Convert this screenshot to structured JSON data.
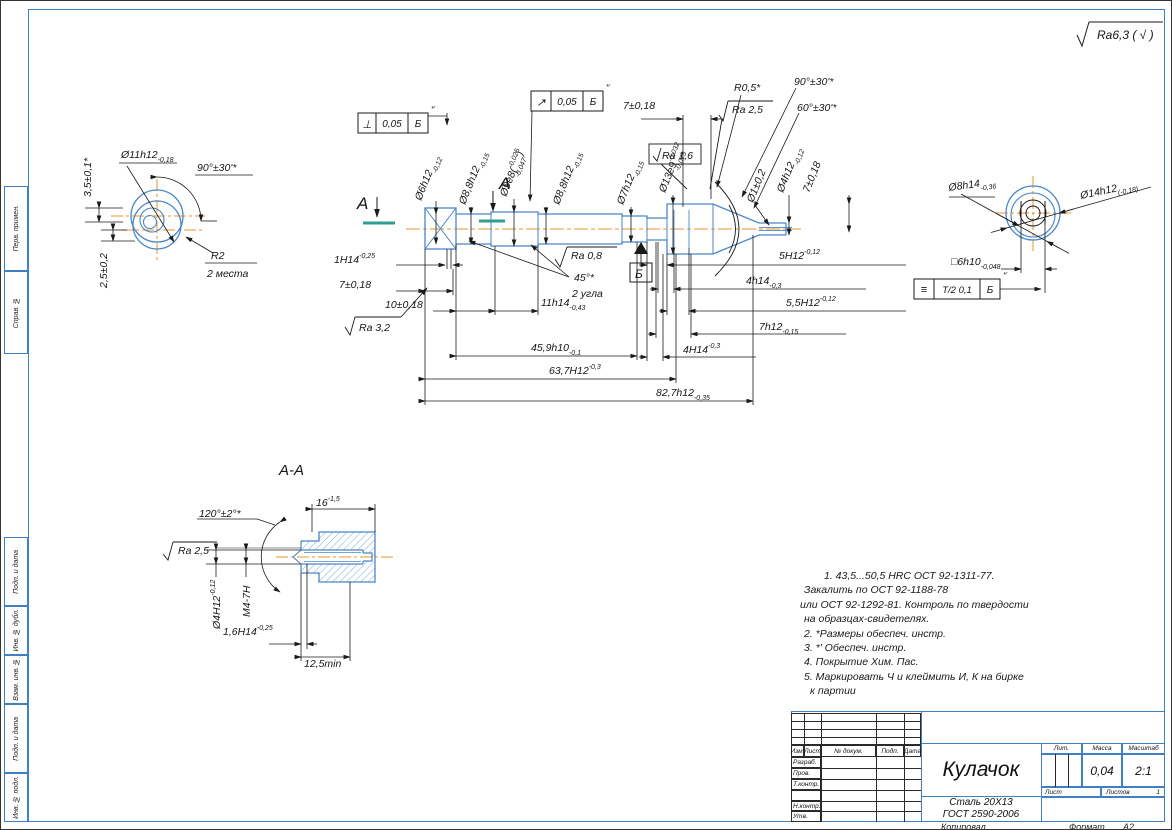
{
  "sheet": {
    "general_roughness": "Ra6,3 ( √ )",
    "copied": "Копировал",
    "format_label": "Формат",
    "format_value": "А2"
  },
  "colors": {
    "outline_blue": "#4a86c8",
    "centerline_orange": "#e8932c",
    "section_teal": "#2f9e8f",
    "line_black": "#1a1a1a"
  },
  "margin_stamps": [
    "Перв. примен.",
    "Справ. №",
    "Подп. и дата",
    "Инв. № дубл.",
    "Взам. инв. №",
    "Подп. и дата",
    "Инв. № подл."
  ],
  "gdt": [
    {
      "sym": "⊥",
      "val": "0,05",
      "datum": "Б",
      "note": "*'"
    },
    {
      "sym": "↗",
      "val": "0,05",
      "datum": "Б",
      "note": "*'"
    },
    {
      "sym": "≡",
      "val": "Т/2 0,1",
      "datum": "Б",
      "note": "*'"
    }
  ],
  "datum_label": "Б",
  "notes": {
    "lines": [
      {
        "t": "1. 43,5...50,5 HRC ОСТ 92-1311-77.",
        "ind": 28
      },
      {
        "t": "Закалить по ОСТ 92-1188-78",
        "ind": 8
      },
      {
        "t": "или ОСТ 92-1292-81. Контроль по твердости",
        "ind": 4
      },
      {
        "t": "на образцах-свидетелях.",
        "ind": 8
      },
      {
        "t": "2. *Размеры обеспеч. инстр.",
        "ind": 8
      },
      {
        "t": "3. *' Обеспеч. инстр.",
        "ind": 8
      },
      {
        "t": "4. Покрытие Хим. Пас.",
        "ind": 8
      },
      {
        "t": "5. Маркировать Ч и клеймить И, К на бирке",
        "ind": 8
      },
      {
        "t": "к партии",
        "ind": 14
      }
    ]
  },
  "title_block": {
    "header": {
      "izm": "Изм.",
      "list": "Лист",
      "doc": "№ докум.",
      "sign": "Подп.",
      "date": "Дата"
    },
    "rows": [
      "Разраб.",
      "Пров.",
      "Т.контр.",
      "",
      "Н.контр.",
      "Утв."
    ],
    "part_name": "Кулачок",
    "material_line1": "Сталь 20Х13",
    "material_line2": "ГОСТ 2590-2006",
    "lit_label": "Лит.",
    "mass_label": "Масса",
    "scale_label": "Масштаб",
    "mass_value": "0,04",
    "scale_value": "2:1",
    "sheet_label": "Лист",
    "sheets_label": "Листов",
    "sheets_value": "1"
  },
  "labels": [
    {
      "x": 420,
      "y": 200,
      "r": -68,
      "p": [
        {
          "t": "Ø6h12"
        },
        {
          "t": "-0,12",
          "dy": 4,
          "fs": 7
        }
      ]
    },
    {
      "x": 464,
      "y": 204,
      "r": -68,
      "p": [
        {
          "t": "Ø8,8h12"
        },
        {
          "t": "-0,15",
          "dy": 4,
          "fs": 7
        }
      ]
    },
    {
      "x": 505,
      "y": 196,
      "r": -68,
      "p": [
        {
          "t": "Ø9e8("
        },
        {
          "t": "-0,025",
          "dy": -5,
          "fs": 7
        },
        {
          "t": "-0,047",
          "dx": -26,
          "dy": 10,
          "fs": 7
        },
        {
          "t": ")",
          "dx": 1,
          "dy": -5
        }
      ]
    },
    {
      "x": 558,
      "y": 204,
      "r": -68,
      "p": [
        {
          "t": "Ø8,8h12"
        },
        {
          "t": "-0,15",
          "dy": 4,
          "fs": 7
        }
      ]
    },
    {
      "x": 622,
      "y": 204,
      "r": -68,
      "p": [
        {
          "t": "Ø7h12"
        },
        {
          "t": "-0,15",
          "dy": 4,
          "fs": 7
        }
      ]
    },
    {
      "x": 664,
      "y": 192,
      "r": -68,
      "p": [
        {
          "t": "Ø13e9"
        },
        {
          "t": "-0,032",
          "dy": -5,
          "fs": 7
        },
        {
          "t": "-0,075",
          "dx": -26,
          "dy": 10,
          "fs": 7
        }
      ]
    },
    {
      "x": 752,
      "y": 202,
      "r": -68,
      "p": [
        {
          "t": "Ø1±0,2"
        }
      ]
    },
    {
      "x": 782,
      "y": 192,
      "r": -68,
      "p": [
        {
          "t": "Ø4h12"
        },
        {
          "t": "-0,12",
          "dy": 4,
          "fs": 7
        }
      ]
    },
    {
      "x": 808,
      "y": 192,
      "r": -68,
      "p": [
        {
          "t": "7±0,18"
        }
      ]
    },
    {
      "x": 622,
      "y": 108,
      "p": [
        {
          "t": "7±0,18"
        }
      ]
    },
    {
      "x": 733,
      "y": 90,
      "p": [
        {
          "t": "R0,5*"
        }
      ]
    },
    {
      "x": 793,
      "y": 84,
      "p": [
        {
          "t": "90°±30'*"
        }
      ]
    },
    {
      "x": 796,
      "y": 110,
      "p": [
        {
          "t": "60°±30'*"
        }
      ]
    },
    {
      "x": 731,
      "y": 112,
      "p": [
        {
          "t": "Ra 2,5"
        }
      ]
    },
    {
      "x": 661,
      "y": 158,
      "p": [
        {
          "t": "Ra 1,6"
        }
      ]
    },
    {
      "x": 333,
      "y": 262,
      "p": [
        {
          "t": "1H14"
        },
        {
          "t": "-0,25",
          "dy": -5,
          "fs": 7
        }
      ]
    },
    {
      "x": 338,
      "y": 287,
      "p": [
        {
          "t": "7±0,18"
        }
      ]
    },
    {
      "x": 384,
      "y": 307,
      "p": [
        {
          "t": "10±0,18"
        }
      ]
    },
    {
      "x": 540,
      "y": 305,
      "p": [
        {
          "t": "11h14"
        },
        {
          "t": "-0,43",
          "dy": 4,
          "fs": 7
        }
      ]
    },
    {
      "x": 358,
      "y": 330,
      "p": [
        {
          "t": "Ra 3,2"
        }
      ]
    },
    {
      "x": 570,
      "y": 258,
      "p": [
        {
          "t": "Ra 0,8"
        }
      ]
    },
    {
      "x": 573,
      "y": 280,
      "p": [
        {
          "t": "45°*"
        }
      ]
    },
    {
      "x": 571,
      "y": 296,
      "p": [
        {
          "t": "2 угла"
        }
      ]
    },
    {
      "x": 530,
      "y": 350,
      "p": [
        {
          "t": "45,9h10"
        },
        {
          "t": "-0,1",
          "dy": 4,
          "fs": 7
        }
      ]
    },
    {
      "x": 548,
      "y": 373,
      "p": [
        {
          "t": "63,7H12"
        },
        {
          "t": "-0,3",
          "dy": -5,
          "fs": 7
        }
      ]
    },
    {
      "x": 655,
      "y": 395,
      "p": [
        {
          "t": "82,7h12"
        },
        {
          "t": "-0,35",
          "dy": 4,
          "fs": 7
        }
      ]
    },
    {
      "x": 778,
      "y": 258,
      "p": [
        {
          "t": "5H12"
        },
        {
          "t": "-0,12",
          "dy": -5,
          "fs": 7
        }
      ]
    },
    {
      "x": 745,
      "y": 283,
      "p": [
        {
          "t": "4h14"
        },
        {
          "t": "-0,3",
          "dy": 4,
          "fs": 7
        }
      ]
    },
    {
      "x": 785,
      "y": 305,
      "p": [
        {
          "t": "5,5H12"
        },
        {
          "t": "-0,12",
          "dy": -5,
          "fs": 7
        }
      ]
    },
    {
      "x": 758,
      "y": 329,
      "p": [
        {
          "t": "7h12"
        },
        {
          "t": "-0,15",
          "dy": 4,
          "fs": 7
        }
      ]
    },
    {
      "x": 682,
      "y": 352,
      "p": [
        {
          "t": "4H14"
        },
        {
          "t": "-0,3",
          "dy": -5,
          "fs": 7
        }
      ]
    },
    {
      "x": 356,
      "y": 208,
      "fs": 17,
      "p": [
        {
          "t": "А"
        }
      ]
    },
    {
      "x": 498,
      "y": 188,
      "fs": 17,
      "p": [
        {
          "t": "А"
        }
      ]
    },
    {
      "x": 120,
      "y": 157,
      "p": [
        {
          "t": "Ø11h12"
        },
        {
          "t": "-0,18",
          "dy": 4,
          "fs": 7
        }
      ]
    },
    {
      "x": 196,
      "y": 170,
      "p": [
        {
          "t": "90°±30'*"
        }
      ]
    },
    {
      "x": 90,
      "y": 196,
      "r": -90,
      "p": [
        {
          "t": "3,5±0,1*"
        }
      ]
    },
    {
      "x": 106,
      "y": 287,
      "r": -90,
      "p": [
        {
          "t": "2,5±0,2"
        }
      ]
    },
    {
      "x": 210,
      "y": 258,
      "p": [
        {
          "t": "R2"
        }
      ]
    },
    {
      "x": 206,
      "y": 276,
      "p": [
        {
          "t": "2 места"
        }
      ]
    },
    {
      "x": 948,
      "y": 190,
      "r": -8,
      "p": [
        {
          "t": "Ø8h14"
        },
        {
          "t": "-0,36",
          "dy": 4,
          "fs": 7
        }
      ]
    },
    {
      "x": 1080,
      "y": 198,
      "r": -12,
      "p": [
        {
          "t": "Ø14h12"
        },
        {
          "t": "(-0,18)",
          "dy": 4,
          "fs": 7
        }
      ]
    },
    {
      "x": 950,
      "y": 264,
      "p": [
        {
          "t": "□6h10"
        },
        {
          "t": "-0,048",
          "dy": 4,
          "fs": 7
        }
      ]
    },
    {
      "x": 278,
      "y": 474,
      "fs": 15,
      "p": [
        {
          "t": "А-А"
        }
      ]
    },
    {
      "x": 198,
      "y": 516,
      "p": [
        {
          "t": "120°±2°*"
        }
      ]
    },
    {
      "x": 315,
      "y": 505,
      "p": [
        {
          "t": "16"
        },
        {
          "t": "-1,5",
          "dy": -5,
          "fs": 7
        }
      ]
    },
    {
      "x": 177,
      "y": 553,
      "p": [
        {
          "t": "Ra 2,5"
        }
      ]
    },
    {
      "x": 219,
      "y": 628,
      "r": -90,
      "p": [
        {
          "t": "Ø4H12"
        },
        {
          "t": "-0,12",
          "dy": -5,
          "fs": 7
        }
      ]
    },
    {
      "x": 249,
      "y": 616,
      "r": -90,
      "p": [
        {
          "t": "М4-7Н"
        }
      ]
    },
    {
      "x": 222,
      "y": 634,
      "p": [
        {
          "t": "1,6H14"
        },
        {
          "t": "-0,25",
          "dy": -5,
          "fs": 7
        }
      ]
    },
    {
      "x": 303,
      "y": 666,
      "p": [
        {
          "t": "12,5min"
        }
      ]
    },
    {
      "x": 1096,
      "y": 38,
      "fs": 12,
      "n": "general-roughness-text",
      "p": [
        {
          "t": "Ra6,3 ( √ )"
        }
      ]
    },
    {
      "x": 634,
      "y": 277,
      "fs": 12,
      "n": "datum-letter",
      "p": [
        {
          "t": "Б"
        }
      ]
    }
  ]
}
